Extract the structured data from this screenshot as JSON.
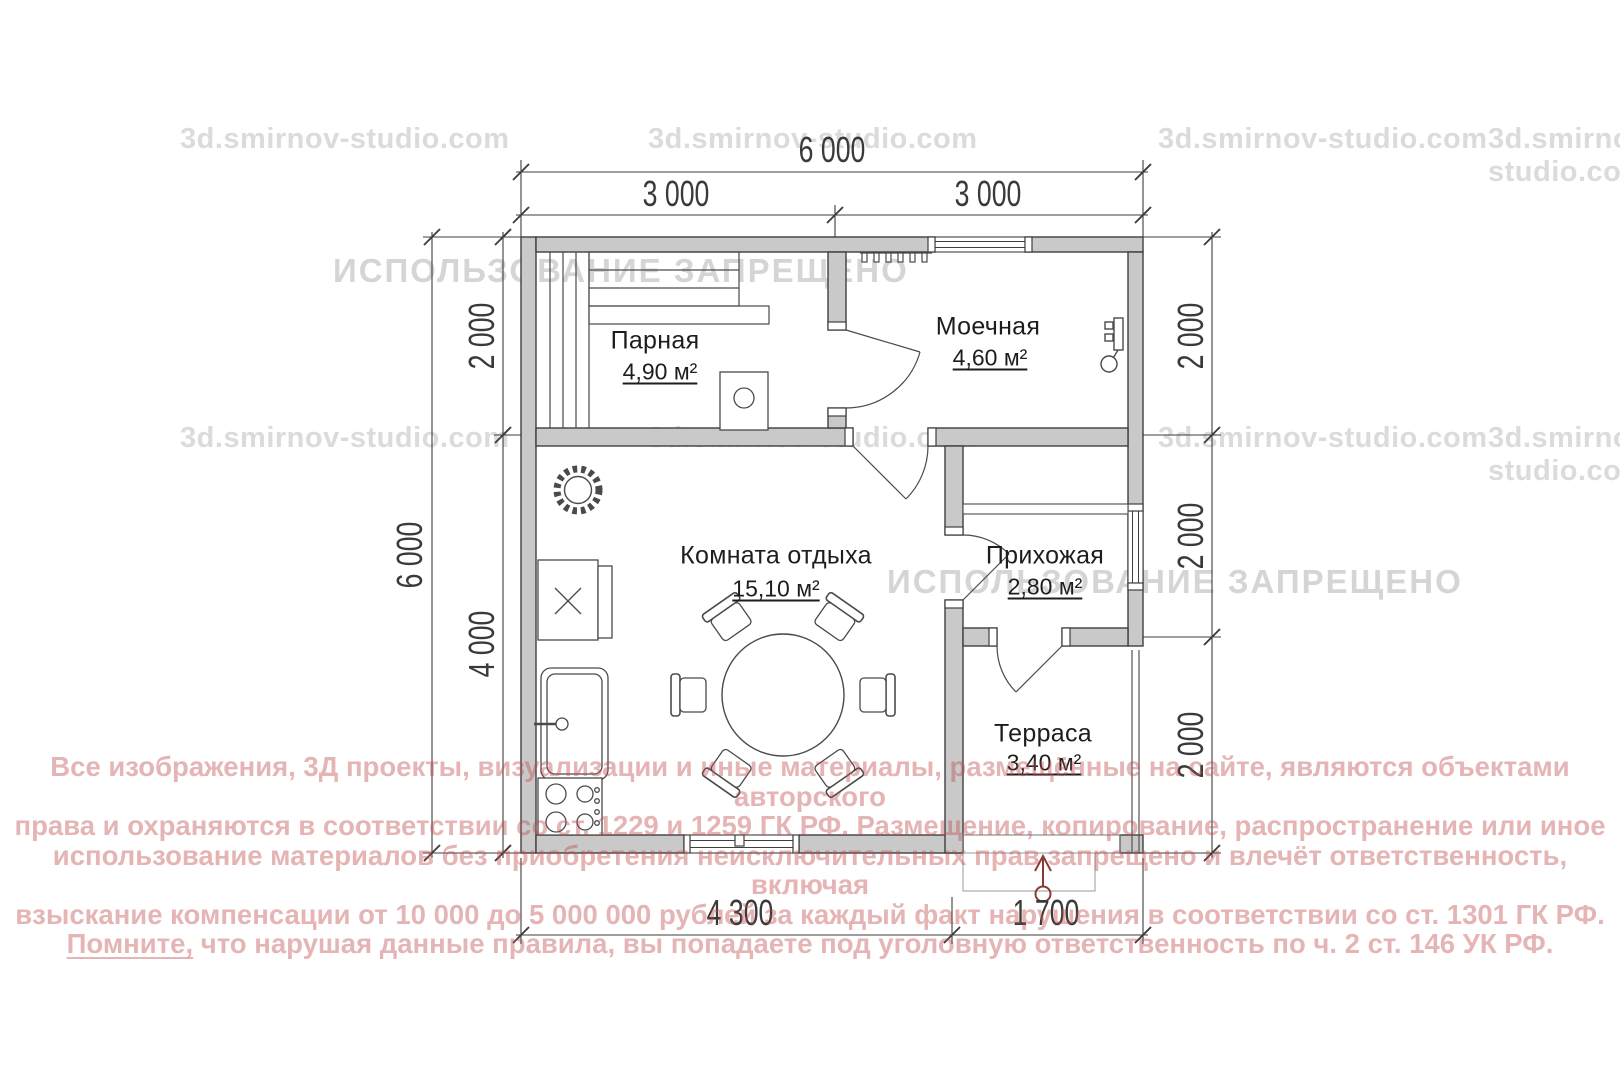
{
  "site_watermark": "3d.smirnov-studio.com",
  "forbidden_watermark": "ИСПОЛЬЗОВАНИЕ ЗАПРЕЩЕНО",
  "legal": {
    "line1": "Все изображения, 3Д проекты, визуализации и иные материалы, размещённые на сайте, являются объектами авторского",
    "line2": "права и охраняются в соответствии со ст. 1229 и 1259 ГК РФ. Размещение, копирование, распространение или иное",
    "line3": "использование материалов без приобретения неисключительных прав запрещено и влечёт ответственность, включая",
    "line4": "взыскание компенсации от 10 000 до 5 000 000 рублей за каждый факт нарушения в соответствии со ст. 1301 ГК РФ.",
    "line5_lead": "Помните,",
    "line5_rest": " что нарушая данные правила, вы попадаете под уголовную ответственность по ч. 2 ст. 146 УК РФ."
  },
  "rooms": {
    "parnaya": {
      "name": "Парная",
      "area": "4,90 м²"
    },
    "moechnaya": {
      "name": "Моечная",
      "area": "4,60 м²"
    },
    "lounge": {
      "name": "Комната отдыха",
      "area": "15,10 м²"
    },
    "hallway": {
      "name": "Прихожая",
      "area": "2,80 м²"
    },
    "terrace": {
      "name": "Терраса",
      "area": "3,40 м²"
    }
  },
  "dimensions": {
    "top_total": "6 000",
    "top_left": "3 000",
    "top_right": "3 000",
    "left_total": "6 000",
    "left_upper": "2 000",
    "left_lower": "4 000",
    "right_upper": "2 000",
    "right_middle": "2 000",
    "right_lower": "2 000",
    "bottom_left": "4 300",
    "bottom_right": "1 700"
  },
  "colors": {
    "wall_fill": "#c9c9c9",
    "line": "#3f3f3f",
    "watermark_gray": "#bebebe",
    "legal_red": "#c24b4b",
    "entry_arrow": "#8a3b34"
  }
}
